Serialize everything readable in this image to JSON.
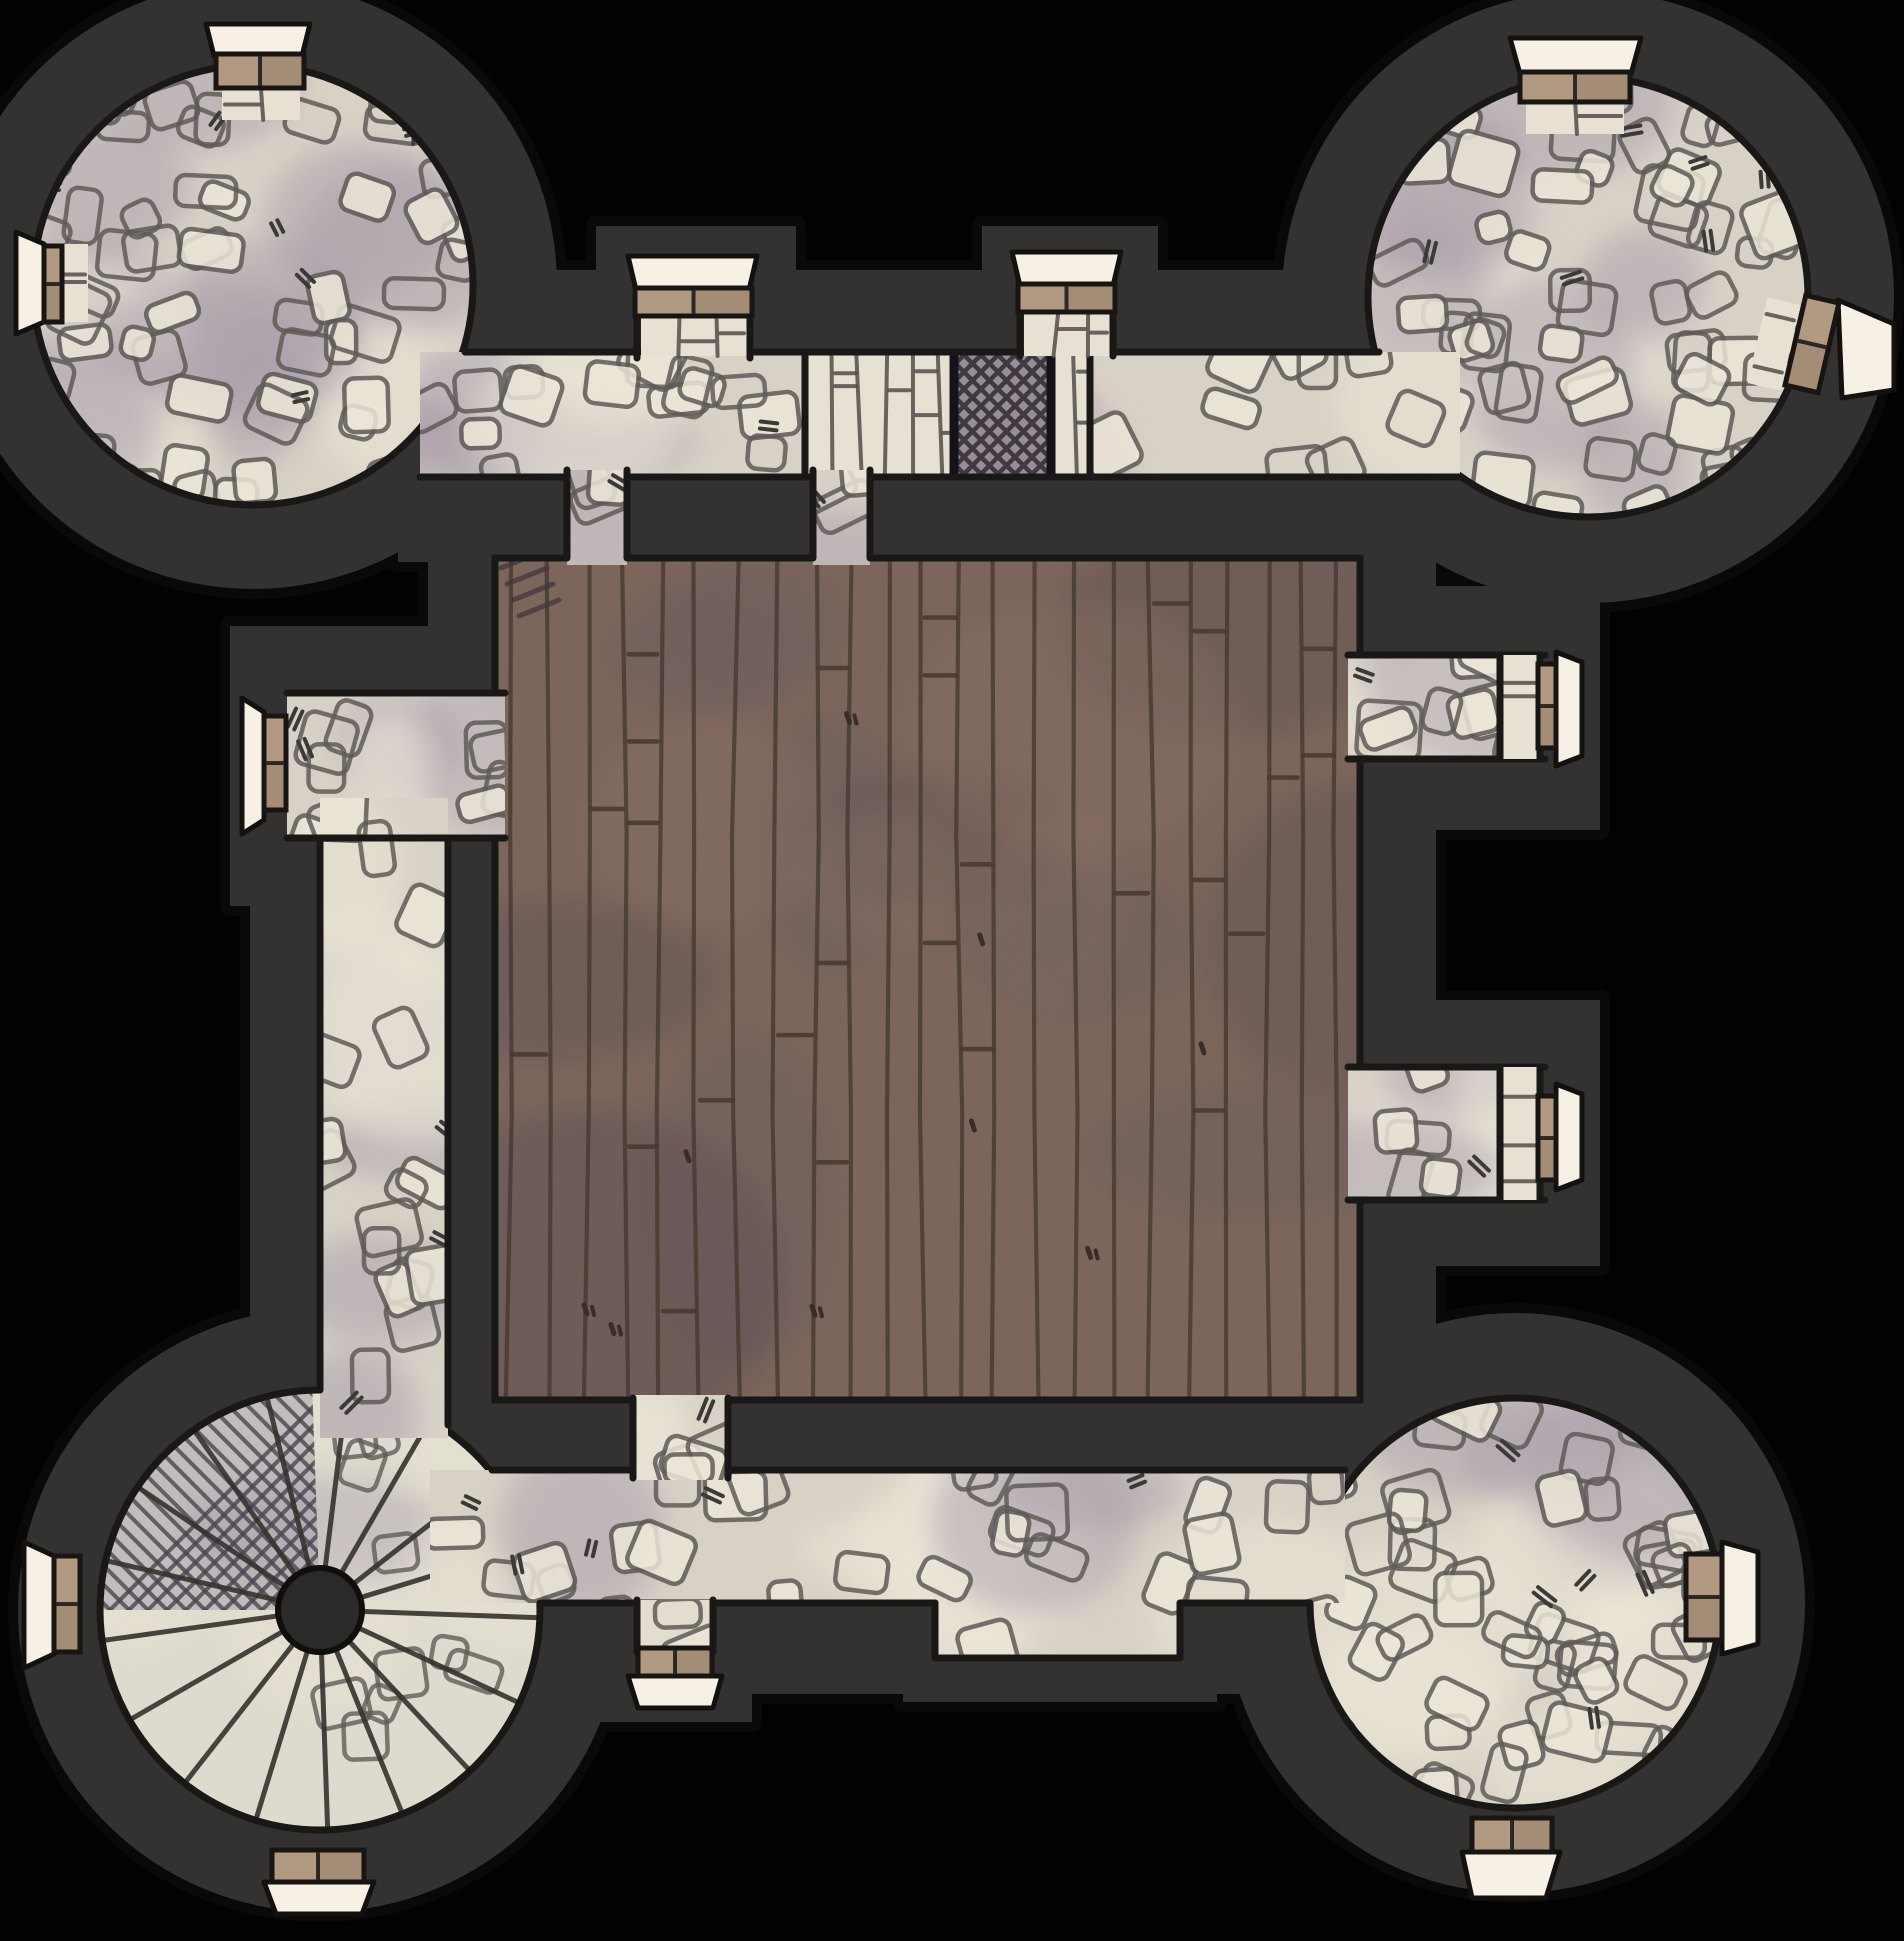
{
  "canvas": {
    "width": 1904,
    "height": 1941
  },
  "palette": {
    "void": "#020202",
    "wall": "#343231",
    "wall_outline": "#0a0908",
    "floor_outline": "#1a1816",
    "cobble_base": "#d8d2c6",
    "cobble_light": "#ece6d8",
    "cobble_shadow": "#a89eaa",
    "stone_line": "#5f5b57",
    "tick": "#3c3937",
    "wood_base": "#7c665c",
    "wood_light": "#8b7366",
    "wood_shadow": "#5c4b51",
    "wood_purple": "#6a5a61",
    "wood_line": "#46392e",
    "brick_base": "#e7e1d3",
    "brick_line": "#524e4a",
    "grate_base": "#9a8c95",
    "grate_line": "#3e3a42",
    "grate_frame": "#15121a",
    "door_fill": "#b19982",
    "door_stroke": "#181512",
    "door_split": "#2e2a25",
    "threshold_fill": "#f6f1e4",
    "threshold_stroke": "#121110",
    "stair_base": "#dedacd",
    "stair_line": "#35322e",
    "hub_fill": "#2c2a29",
    "hatch_fill": "#a39aa7",
    "hatch_line": "#4b4650"
  },
  "walls": [
    {
      "type": "circle",
      "cx": 253,
      "cy": 285,
      "r": 304
    },
    {
      "type": "circle",
      "cx": 1588,
      "cy": 297,
      "r": 306
    },
    {
      "type": "circle",
      "cx": 320,
      "cy": 1610,
      "r": 302
    },
    {
      "type": "circle",
      "cx": 1515,
      "cy": 1603,
      "r": 290
    },
    {
      "type": "rect",
      "x": 398,
      "y": 270,
      "w": 1080,
      "h": 292
    },
    {
      "type": "rect",
      "x": 596,
      "y": 226,
      "w": 200,
      "h": 140
    },
    {
      "type": "rect",
      "x": 982,
      "y": 226,
      "w": 176,
      "h": 140
    },
    {
      "type": "rect",
      "x": 428,
      "y": 480,
      "w": 1008,
      "h": 1000
    },
    {
      "type": "rect",
      "x": 230,
      "y": 626,
      "w": 280,
      "h": 280
    },
    {
      "type": "rect",
      "x": 250,
      "y": 778,
      "w": 266,
      "h": 684
    },
    {
      "type": "rect",
      "x": 1336,
      "y": 586,
      "w": 264,
      "h": 244
    },
    {
      "type": "rect",
      "x": 1336,
      "y": 1000,
      "w": 264,
      "h": 266
    },
    {
      "type": "rect",
      "x": 396,
      "y": 1394,
      "w": 1004,
      "h": 300
    },
    {
      "type": "rect",
      "x": 558,
      "y": 1598,
      "w": 194,
      "h": 124
    },
    {
      "type": "rect",
      "x": 903,
      "y": 1558,
      "w": 314,
      "h": 144
    }
  ],
  "floors": [
    {
      "id": "tower-northwest-floor",
      "kind": "cobble",
      "shape": {
        "type": "circle",
        "cx": 253,
        "cy": 285,
        "r": 220
      },
      "seed": 11,
      "stones": 58,
      "blobs": 13,
      "ticks": 7,
      "outline": "full"
    },
    {
      "id": "tower-northeast-floor",
      "kind": "cobble",
      "shape": {
        "type": "circle",
        "cx": 1588,
        "cy": 297,
        "r": 220
      },
      "seed": 22,
      "stones": 58,
      "blobs": 13,
      "ticks": 7,
      "outline": "full"
    },
    {
      "id": "tower-southeast-floor",
      "kind": "cobble",
      "shape": {
        "type": "circle",
        "cx": 1515,
        "cy": 1603,
        "r": 205
      },
      "seed": 33,
      "stones": 52,
      "blobs": 11,
      "ticks": 6,
      "outline": "full"
    },
    {
      "id": "tower-southwest-spiral-stair",
      "kind": "spiral",
      "shape": {
        "type": "circle",
        "cx": 320,
        "cy": 1610,
        "r": 220
      },
      "seed": 44,
      "hub_r": 42,
      "radials": [
        2,
        25,
        47,
        68,
        88,
        107,
        128,
        150,
        172,
        193,
        214,
        235,
        256,
        277,
        300,
        322,
        343
      ],
      "hatch_sector": [
        180,
        268
      ],
      "stones": 10,
      "outline": "full"
    },
    {
      "id": "central-hall-wood-floor",
      "kind": "wood",
      "shape": {
        "type": "rect",
        "x": 495,
        "y": 558,
        "w": 865,
        "h": 842
      },
      "seed": 55,
      "planks": 24,
      "joints": 26,
      "knots": 9,
      "blobs": 14,
      "outline": "full"
    },
    {
      "id": "north-corridor-floor",
      "kind": "cobble",
      "shape": {
        "type": "rect",
        "x": 420,
        "y": 352,
        "w": 1040,
        "h": 125
      },
      "seed": 66,
      "stones": 30,
      "blobs": 9,
      "ticks": 5,
      "outline": "none"
    },
    {
      "id": "north-corridor-brick-band",
      "kind": "brick",
      "shape": {
        "type": "rect",
        "x": 805,
        "y": 352,
        "w": 285,
        "h": 125
      },
      "seed": 77,
      "vgap": 27,
      "hjoints": 8,
      "edges": true
    },
    {
      "id": "north-corridor-grate",
      "kind": "grate",
      "shape": {
        "type": "rect",
        "x": 950,
        "y": 352,
        "w": 105,
        "h": 125
      }
    },
    {
      "id": "west-corridor-floor",
      "kind": "cobble",
      "shape": {
        "type": "rect",
        "x": 287,
        "y": 693,
        "w": 218,
        "h": 145
      },
      "seed": 88,
      "stones": 9,
      "blobs": 4,
      "ticks": 2,
      "outline": "none"
    },
    {
      "id": "west-wing-corridor-floor",
      "kind": "cobble",
      "shape": {
        "type": "rect",
        "x": 320,
        "y": 798,
        "w": 128,
        "h": 640
      },
      "seed": 99,
      "stones": 16,
      "blobs": 7,
      "ticks": 3,
      "outline": "none"
    },
    {
      "id": "east-upper-corridor-floor",
      "kind": "cobble",
      "shape": {
        "type": "rect",
        "x": 1348,
        "y": 655,
        "w": 192,
        "h": 104
      },
      "seed": 111,
      "stones": 8,
      "blobs": 4,
      "ticks": 2,
      "outline": "none"
    },
    {
      "id": "east-lower-corridor-floor",
      "kind": "cobble",
      "shape": {
        "type": "rect",
        "x": 1348,
        "y": 1067,
        "w": 192,
        "h": 133
      },
      "seed": 122,
      "stones": 9,
      "blobs": 4,
      "ticks": 2,
      "outline": "none"
    },
    {
      "id": "south-corridor-floor",
      "kind": "cobble",
      "shape": {
        "type": "poly",
        "points": "430,1470 1345,1470 1345,1603 1180,1603 1180,1658 935,1658 935,1603 430,1603",
        "bbox": [
          430,
          1470,
          915,
          188
        ]
      },
      "seed": 133,
      "stones": 30,
      "blobs": 10,
      "ticks": 5,
      "outline": "none"
    },
    {
      "kind": "lines",
      "id": "corridor-pencil-edges",
      "segments": [
        [
          465,
          352,
          1379,
          352
        ],
        [
          420,
          477,
          1460,
          477
        ],
        [
          805,
          352,
          805,
          477
        ],
        [
          1090,
          352,
          1090,
          477
        ],
        [
          287,
          693,
          505,
          693
        ],
        [
          287,
          838,
          505,
          838
        ],
        [
          320,
          838,
          320,
          1390
        ],
        [
          448,
          838,
          448,
          1425
        ],
        [
          1348,
          655,
          1545,
          655
        ],
        [
          1348,
          759,
          1545,
          759
        ],
        [
          1348,
          1067,
          1545,
          1067
        ],
        [
          1348,
          1200,
          1545,
          1200
        ],
        [
          492,
          1470,
          1345,
          1470
        ],
        [
          540,
          1603,
          935,
          1603
        ],
        [
          935,
          1603,
          935,
          1658
        ],
        [
          935,
          1658,
          1180,
          1658
        ],
        [
          1180,
          1603,
          1180,
          1658
        ],
        [
          1180,
          1603,
          1310,
          1603
        ]
      ]
    },
    {
      "id": "hall-north-left-opening",
      "kind": "cobble",
      "shape": {
        "type": "rect",
        "x": 567,
        "y": 470,
        "w": 60,
        "h": 95
      },
      "seed": 144,
      "stones": 3,
      "blobs": 1,
      "ticks": 1,
      "outline": "none"
    },
    {
      "id": "hall-north-right-opening",
      "kind": "cobble",
      "shape": {
        "type": "rect",
        "x": 813,
        "y": 470,
        "w": 57,
        "h": 95
      },
      "seed": 155,
      "stones": 3,
      "blobs": 1,
      "ticks": 1,
      "outline": "none"
    },
    {
      "id": "hall-south-opening",
      "kind": "cobble",
      "shape": {
        "type": "rect",
        "x": 633,
        "y": 1395,
        "w": 95,
        "h": 85
      },
      "seed": 166,
      "stones": 4,
      "blobs": 2,
      "ticks": 1,
      "outline": "none"
    },
    {
      "id": "south-gate-passage",
      "kind": "cobble",
      "shape": {
        "type": "rect",
        "x": 637,
        "y": 1600,
        "w": 76,
        "h": 55
      },
      "seed": 177,
      "stones": 2,
      "blobs": 1,
      "ticks": 0,
      "outline": "none"
    },
    {
      "id": "north-gate-west-brick",
      "kind": "brick",
      "shape": {
        "type": "rect",
        "x": 641,
        "y": 312,
        "w": 106,
        "h": 44
      },
      "seed": 188,
      "vgap": 38,
      "hjoints": 2
    },
    {
      "id": "north-gate-east-brick",
      "kind": "brick",
      "shape": {
        "type": "rect",
        "x": 1024,
        "y": 310,
        "w": 86,
        "h": 46
      },
      "seed": 199,
      "vgap": 32,
      "hjoints": 2
    },
    {
      "id": "east-upper-door-brick",
      "kind": "brick",
      "shape": {
        "type": "rect",
        "x": 1500,
        "y": 655,
        "w": 40,
        "h": 104
      },
      "seed": 211,
      "vgap": 44,
      "hjoints": 2
    },
    {
      "id": "east-lower-door-brick",
      "kind": "brick",
      "shape": {
        "type": "rect",
        "x": 1500,
        "y": 1067,
        "w": 40,
        "h": 133
      },
      "seed": 222,
      "vgap": 44,
      "hjoints": 3
    },
    {
      "id": "nw-north-door-brick",
      "kind": "brick",
      "shape": {
        "type": "rect",
        "x": 222,
        "y": 86,
        "w": 78,
        "h": 34
      },
      "seed": 233,
      "vgap": 40,
      "hjoints": 1
    },
    {
      "id": "nw-west-door-brick",
      "kind": "brick",
      "shape": {
        "type": "rect",
        "x": 62,
        "y": 244,
        "w": 26,
        "h": 78
      },
      "seed": 244,
      "vgap": 30,
      "hjoints": 2
    },
    {
      "id": "ne-north-door-brick",
      "kind": "brick",
      "shape": {
        "type": "rect",
        "x": 1526,
        "y": 100,
        "w": 98,
        "h": 34
      },
      "seed": 255,
      "vgap": 50,
      "hjoints": 1
    },
    {
      "id": "ne-east-door-brick",
      "kind": "brick",
      "shape": {
        "type": "rect",
        "x": 1757,
        "y": 300,
        "w": 34,
        "h": 88
      },
      "seed": 266,
      "vgap": 36,
      "hjoints": 2,
      "rot": [
        13,
        1774,
        344
      ]
    },
    {
      "kind": "lines",
      "id": "opening-pencil-edges",
      "segments": [
        [
          567,
          470,
          567,
          558
        ],
        [
          627,
          470,
          627,
          558
        ],
        [
          813,
          470,
          813,
          558
        ],
        [
          870,
          470,
          870,
          558
        ],
        [
          633,
          1398,
          633,
          1478
        ],
        [
          728,
          1398,
          728,
          1478
        ],
        [
          637,
          1600,
          637,
          1652
        ],
        [
          713,
          1600,
          713,
          1652
        ],
        [
          637,
          310,
          637,
          358
        ],
        [
          750,
          310,
          750,
          358
        ],
        [
          1020,
          308,
          1020,
          356
        ],
        [
          1113,
          308,
          1113,
          356
        ],
        [
          1500,
          655,
          1500,
          759
        ],
        [
          1540,
          655,
          1540,
          759
        ],
        [
          1500,
          1067,
          1500,
          1200
        ],
        [
          1540,
          1067,
          1540,
          1200
        ]
      ]
    }
  ],
  "doors": [
    {
      "id": "door-nw-tower-north-exterior",
      "bar": {
        "x": 216,
        "y": 54,
        "w": 88,
        "h": 34,
        "split": "v"
      },
      "threshold": "206,24 310,24 302,56 214,56"
    },
    {
      "id": "door-nw-tower-west-exterior",
      "bar": {
        "x": 44,
        "y": 246,
        "w": 18,
        "h": 76,
        "split": "h"
      },
      "threshold": "16,232 44,244 44,322 16,334"
    },
    {
      "id": "door-north-gate-west",
      "bar": {
        "x": 635,
        "y": 288,
        "w": 117,
        "h": 28,
        "split": "v"
      },
      "threshold": "628,256 757,256 749,290 636,290"
    },
    {
      "id": "door-north-gate-east",
      "bar": {
        "x": 1018,
        "y": 284,
        "w": 97,
        "h": 28,
        "split": "v"
      },
      "threshold": "1012,252 1121,252 1113,286 1020,286"
    },
    {
      "id": "door-ne-tower-north-exterior",
      "bar": {
        "x": 1520,
        "y": 72,
        "w": 110,
        "h": 30,
        "split": "v"
      },
      "threshold": "1510,38 1641,38 1631,74 1520,74"
    },
    {
      "id": "door-ne-tower-east-exterior",
      "bar": {
        "x": 1795,
        "y": 298,
        "w": 34,
        "h": 92,
        "split": "h",
        "rot": [
          13,
          1812,
          344
        ]
      },
      "threshold": "1838,300 1894,324 1894,390 1842,398"
    },
    {
      "id": "door-hall-west-exterior",
      "bar": {
        "x": 264,
        "y": 716,
        "w": 22,
        "h": 94,
        "split": "h"
      },
      "threshold": "242,698 264,712 264,820 242,834"
    },
    {
      "id": "door-hall-east-upper-exterior",
      "bar": {
        "x": 1538,
        "y": 664,
        "w": 18,
        "h": 84,
        "split": "h"
      },
      "threshold": "1556,652 1582,662 1582,756 1556,766"
    },
    {
      "id": "door-hall-east-lower-exterior",
      "bar": {
        "x": 1538,
        "y": 1096,
        "w": 18,
        "h": 84,
        "split": "h"
      },
      "threshold": "1556,1084 1582,1094 1582,1180 1556,1190"
    },
    {
      "id": "door-south-gate-exterior",
      "bar": {
        "x": 638,
        "y": 1648,
        "w": 74,
        "h": 28,
        "split": "v"
      },
      "threshold": "628,1676 722,1676 713,1708 638,1708"
    },
    {
      "id": "door-sw-tower-west-exterior",
      "bar": {
        "x": 54,
        "y": 1556,
        "w": 26,
        "h": 96,
        "split": "h"
      },
      "threshold": "24,1542 54,1556 54,1654 24,1668"
    },
    {
      "id": "door-sw-tower-south-exterior",
      "bar": {
        "x": 272,
        "y": 1850,
        "w": 92,
        "h": 32,
        "split": "v"
      },
      "threshold": "264,1882 374,1882 362,1914 276,1914"
    },
    {
      "id": "door-se-tower-east-exterior",
      "bar": {
        "x": 1686,
        "y": 1554,
        "w": 36,
        "h": 86,
        "split": "h"
      },
      "threshold": "1722,1542 1758,1552 1758,1644 1722,1654"
    },
    {
      "id": "door-se-tower-south-exterior",
      "bar": {
        "x": 1472,
        "y": 1818,
        "w": 80,
        "h": 34,
        "split": "v"
      },
      "threshold": "1462,1852 1560,1852 1546,1898 1472,1898"
    }
  ]
}
